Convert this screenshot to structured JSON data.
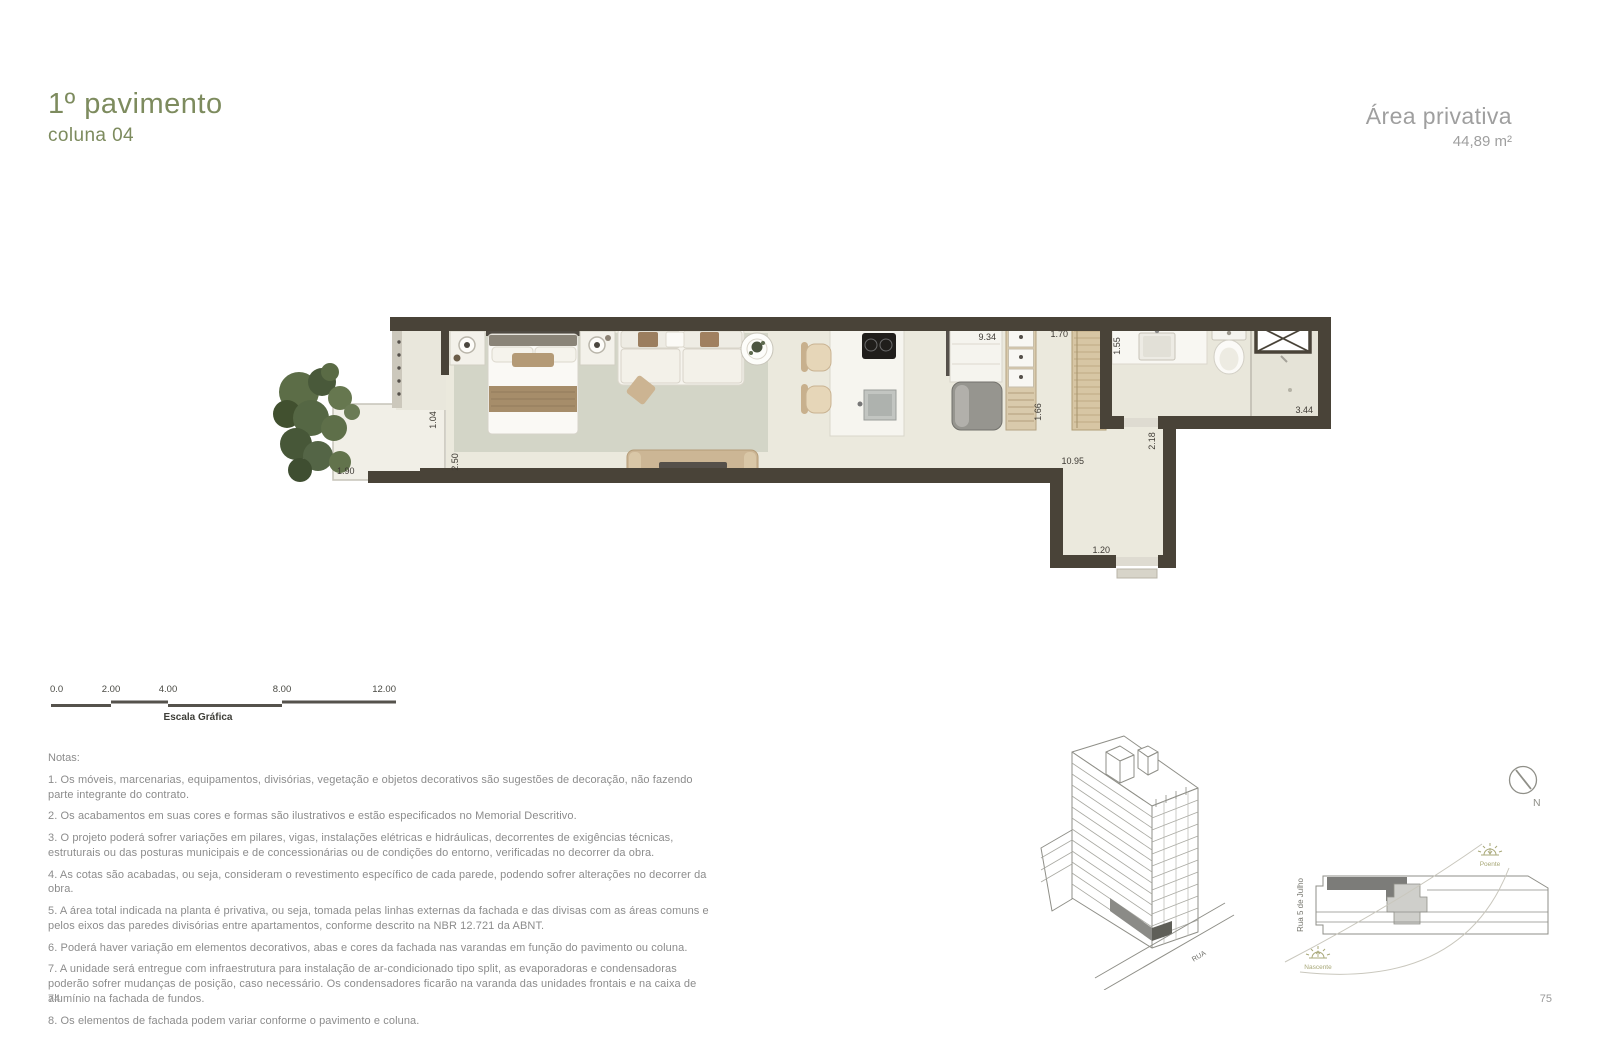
{
  "header": {
    "title": "1º pavimento",
    "subtitle": "coluna 04",
    "area_label": "Área privativa",
    "area_value": "44,89 m²"
  },
  "plan": {
    "dimensions": {
      "balcony_width": "1.90",
      "balcony_depth": "1.04",
      "bedroom_width": "2.50",
      "kitchen_run": "9.34",
      "closet_height": "1.66",
      "ladder_width": "1.70",
      "bath_counter": "1.55",
      "hall_depth": "2.18",
      "internal_length": "10.95",
      "entry_width": "1.20",
      "bath_length": "3.44"
    }
  },
  "scale_bar": {
    "ticks": [
      "0.0",
      "2.00",
      "4.00",
      "8.00",
      "12.00"
    ],
    "caption": "Escala Gráfica"
  },
  "notes": {
    "heading": "Notas:",
    "items": [
      "1. Os móveis, marcenarias, equipamentos, divisórias, vegetação e objetos decorativos são sugestões de decoração, não fazendo parte integrante do contrato.",
      "2. Os acabamentos em suas cores e formas são ilustrativos e estão especificados no Memorial Descritivo.",
      "3. O projeto poderá sofrer variações em pilares, vigas, instalações elétricas e hidráulicas, decorrentes de exigências técnicas, estruturais ou das posturas municipais e de concessionárias ou de condições do entorno, verificadas no decorrer da obra.",
      "4. As cotas são acabadas, ou seja, consideram o revestimento específico de cada parede, podendo sofrer alterações no decorrer da obra.",
      "5. A área total indicada na planta é privativa, ou seja, tomada pelas linhas externas da fachada e das divisas com as áreas comuns e pelos eixos das paredes divisórias entre apartamentos, conforme descrito na NBR 12.721 da ABNT.",
      "6. Poderá haver variação em elementos decorativos, abas e cores da fachada nas varandas em função do pavimento ou coluna.",
      "7. A unidade será entregue com infraestrutura para instalação de ar-condicionado tipo split, as evaporadoras e condensadoras poderão sofrer mudanças de posição, caso necessário. Os condensadores ficarão na varanda das unidades frontais e na caixa de alumínio na fachada de fundos.",
      "8. Os elementos de fachada podem variar conforme o pavimento e coluna."
    ]
  },
  "site": {
    "street_label": "RUA",
    "street_name": "Rua 5 de Julho",
    "compass_label": "N",
    "sun_west": "Poente",
    "sun_east": "Nascente"
  },
  "footer": {
    "page_left": "74",
    "page_right": "75"
  },
  "colors": {
    "accent_green": "#7d8b5e",
    "wall": "#494338",
    "note_gray": "#8c8c8c"
  }
}
